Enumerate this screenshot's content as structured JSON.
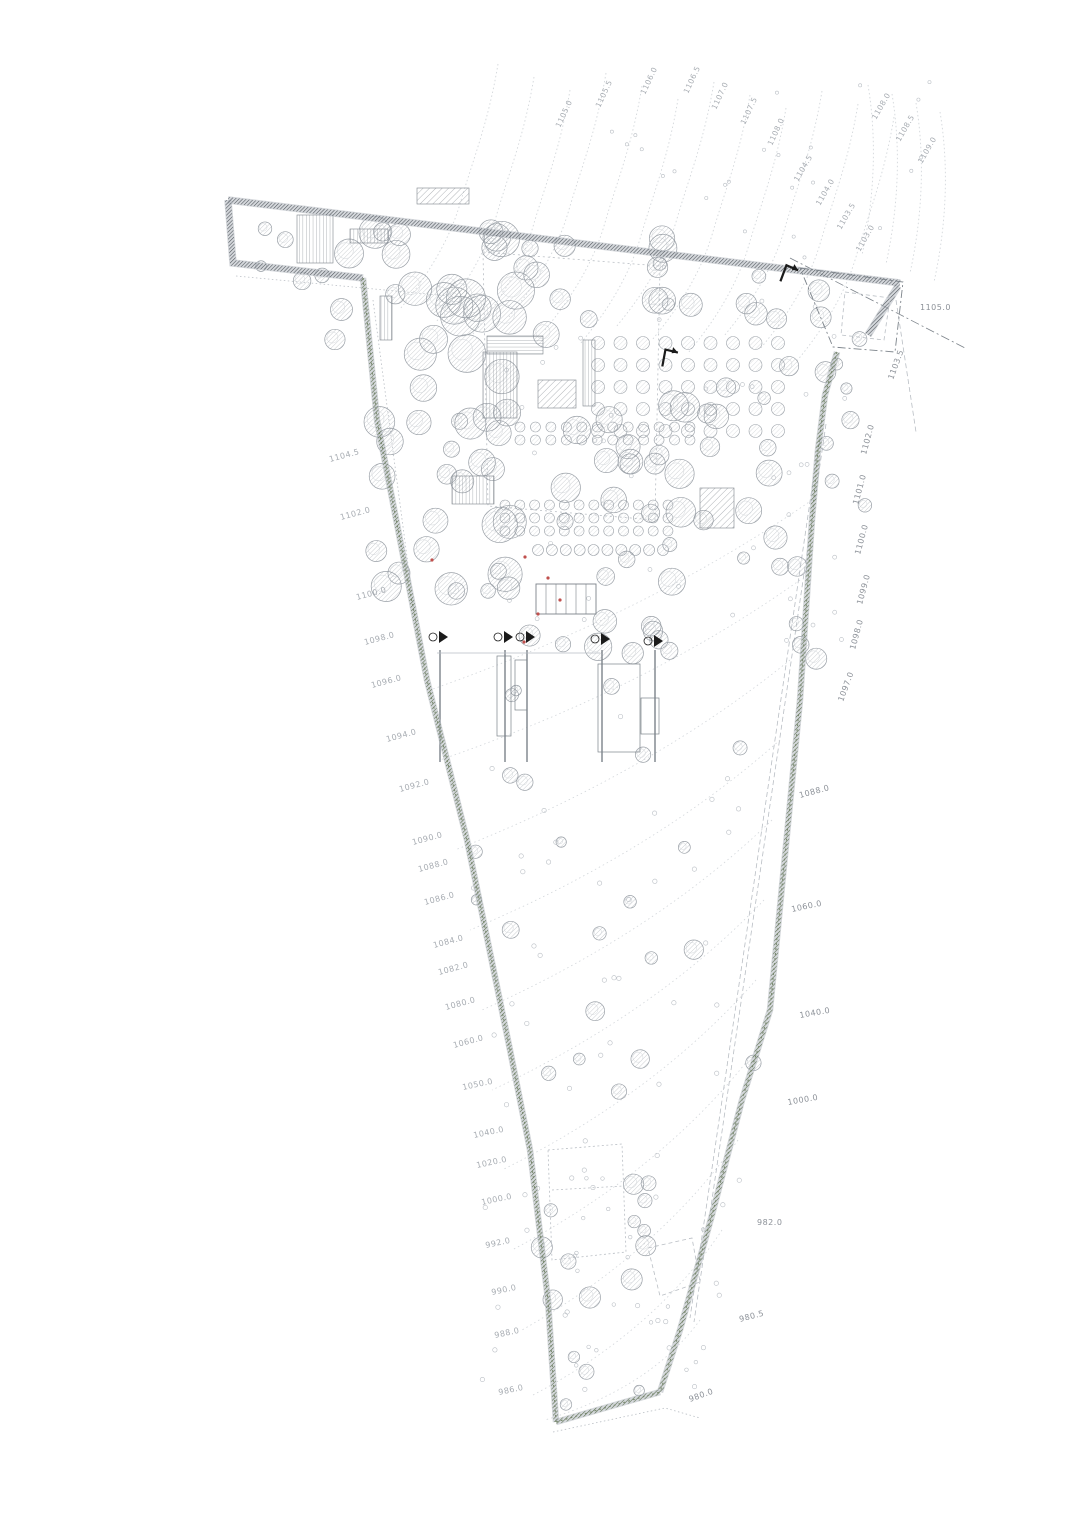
{
  "meta": {
    "drawing_type": "landscape-site-plan",
    "canvas": {
      "w": 1080,
      "h": 1526
    }
  },
  "colors": {
    "line": "#b9bec4",
    "line_faint": "#d3d7db",
    "line_dark": "#7c838a",
    "tree_stroke": "#9aa0a7",
    "tree_hatch": "#8d949b",
    "boundary_hatch": "#4b5157",
    "green_band": "#77876b",
    "green_dark": "#5c7052",
    "label": "#a7acb2",
    "label_dark": "#8c9198",
    "red": "#c0504d",
    "black": "#1b1b1b"
  },
  "boundary": {
    "top_band": [
      [
        228,
        200
      ],
      [
        900,
        283
      ]
    ],
    "west_tip_band": [
      [
        228,
        200
      ],
      [
        233,
        263
      ],
      [
        363,
        278
      ]
    ],
    "east_end_band": [
      [
        898,
        286
      ],
      [
        868,
        335
      ]
    ],
    "west_chain": [
      [
        363,
        278
      ],
      [
        377,
        420
      ],
      [
        427,
        680
      ],
      [
        467,
        840
      ],
      [
        510,
        1050
      ],
      [
        530,
        1150
      ],
      [
        548,
        1300
      ],
      [
        556,
        1422
      ]
    ],
    "east_chain": [
      [
        837,
        352
      ],
      [
        825,
        395
      ],
      [
        818,
        450
      ],
      [
        812,
        520
      ],
      [
        800,
        700
      ],
      [
        786,
        845
      ],
      [
        770,
        1010
      ],
      [
        742,
        1100
      ],
      [
        712,
        1215
      ],
      [
        680,
        1330
      ],
      [
        660,
        1392
      ]
    ],
    "bottom_band": [
      [
        556,
        1422
      ],
      [
        660,
        1392
      ]
    ],
    "protrusion_outer": [
      [
        800,
        268
      ],
      [
        903,
        282
      ],
      [
        895,
        352
      ],
      [
        833,
        347
      ]
    ],
    "protrusion_inner": [
      [
        845,
        292
      ],
      [
        890,
        298
      ],
      [
        884,
        340
      ],
      [
        841,
        335
      ]
    ]
  },
  "aux_lines": {
    "dashdot": [
      [
        [
          790,
          258
        ],
        [
          965,
          348
        ]
      ]
    ],
    "dashed": [
      [
        [
          896,
          300
        ],
        [
          916,
          432
        ]
      ],
      [
        [
          822,
          420
        ],
        [
          690,
          1318
        ]
      ],
      [
        [
          826,
          424
        ],
        [
          694,
          1322
        ]
      ]
    ],
    "dotted": [
      [
        [
          553,
          1432
        ],
        [
          665,
          1408
        ],
        [
          700,
          1418
        ]
      ],
      [
        [
          236,
          276
        ],
        [
          470,
          298
        ]
      ],
      [
        [
          373,
          300
        ],
        [
          420,
          655
        ]
      ]
    ],
    "dotted_poly": [
      [
        [
          483,
          252
        ],
        [
          660,
          266
        ],
        [
          655,
          520
        ],
        [
          488,
          506
        ],
        [
          483,
          252
        ]
      ]
    ]
  },
  "body_contours": [
    [
      [
        812,
        500
      ],
      [
        430,
        690
      ]
    ],
    [
      [
        800,
        580
      ],
      [
        440,
        760
      ]
    ],
    [
      [
        790,
        660
      ],
      [
        455,
        850
      ]
    ],
    [
      [
        780,
        740
      ],
      [
        470,
        930
      ]
    ],
    [
      [
        772,
        820
      ],
      [
        482,
        1010
      ]
    ],
    [
      [
        764,
        900
      ],
      [
        492,
        1090
      ]
    ],
    [
      [
        756,
        980
      ],
      [
        502,
        1170
      ]
    ],
    [
      [
        748,
        1060
      ],
      [
        512,
        1250
      ]
    ],
    [
      [
        738,
        1140
      ],
      [
        522,
        1330
      ]
    ],
    [
      [
        722,
        1230
      ],
      [
        533,
        1395
      ]
    ],
    [
      [
        700,
        1320
      ],
      [
        545,
        1420
      ]
    ]
  ],
  "top_contours": {
    "count": 12,
    "x0": 498,
    "y0": 64,
    "dx": 36
  },
  "corner_contours": {
    "count": 4,
    "x0": 868,
    "y0": 85,
    "dx": 24
  },
  "trees": {
    "clusters": [
      [
        330,
        225,
        200,
        130,
        26,
        8,
        20,
        1
      ],
      [
        520,
        235,
        180,
        100,
        14,
        6,
        14,
        2
      ],
      [
        700,
        275,
        160,
        240,
        18,
        6,
        13,
        3
      ],
      [
        372,
        360,
        150,
        260,
        26,
        8,
        18,
        4
      ],
      [
        520,
        400,
        180,
        130,
        16,
        8,
        16,
        5
      ],
      [
        480,
        540,
        220,
        125,
        16,
        7,
        14,
        6
      ],
      [
        700,
        520,
        120,
        140,
        8,
        6,
        12,
        7
      ],
      [
        460,
        680,
        300,
        440,
        22,
        5,
        10,
        8
      ],
      [
        540,
        1180,
        110,
        160,
        12,
        6,
        12,
        9
      ],
      [
        560,
        1350,
        80,
        55,
        4,
        5,
        8,
        10
      ],
      [
        240,
        228,
        90,
        62,
        5,
        5,
        9,
        11
      ],
      [
        826,
        360,
        48,
        160,
        5,
        5,
        8,
        12
      ]
    ],
    "small_dots": [
      [
        470,
        700,
        270,
        700,
        60,
        2.2,
        21
      ],
      [
        500,
        300,
        350,
        350,
        40,
        2.0,
        22
      ],
      [
        600,
        80,
        330,
        200,
        25,
        1.6,
        23
      ],
      [
        560,
        1160,
        150,
        240,
        18,
        1.8,
        24
      ]
    ],
    "orchard_rows": [
      [
        598,
        343,
        778,
        343,
        9,
        6.5
      ],
      [
        598,
        365,
        778,
        365,
        9,
        6.5
      ],
      [
        598,
        387,
        778,
        387,
        9,
        6.5
      ],
      [
        598,
        409,
        778,
        409,
        9,
        6.5
      ],
      [
        598,
        431,
        778,
        431,
        9,
        6.5
      ],
      [
        520,
        427,
        690,
        427,
        12,
        5
      ],
      [
        520,
        440,
        690,
        440,
        12,
        5
      ],
      [
        505,
        505,
        668,
        505,
        12,
        5
      ],
      [
        505,
        518,
        668,
        518,
        12,
        5
      ],
      [
        505,
        531,
        668,
        531,
        12,
        5
      ],
      [
        538,
        550,
        663,
        550,
        10,
        5.5
      ]
    ]
  },
  "structures": {
    "stripe_v": [
      [
        297,
        215,
        36,
        48
      ],
      [
        350,
        229,
        38,
        14
      ],
      [
        380,
        296,
        12,
        44
      ],
      [
        483,
        352,
        34,
        66
      ],
      [
        583,
        340,
        12,
        66
      ],
      [
        452,
        476,
        42,
        28
      ]
    ],
    "stripe_h": [
      [
        487,
        336,
        56,
        18
      ]
    ],
    "diag": [
      [
        538,
        380,
        38,
        28
      ],
      [
        417,
        188,
        52,
        16
      ],
      [
        700,
        488,
        34,
        40
      ]
    ],
    "room_block": {
      "x": 536,
      "y": 584,
      "w": 60,
      "h": 30,
      "dividers": 5
    },
    "rects": [
      [
        497,
        656,
        14,
        80
      ],
      [
        515,
        660,
        12,
        50
      ],
      [
        598,
        664,
        42,
        88
      ],
      [
        641,
        698,
        18,
        36
      ]
    ],
    "dotted_building": [
      [
        548,
        1150
      ],
      [
        622,
        1144
      ],
      [
        626,
        1252
      ],
      [
        552,
        1260
      ],
      [
        548,
        1150
      ]
    ],
    "dotted_building_inner": [
      [
        552,
        1190
      ],
      [
        624,
        1186
      ]
    ],
    "dashed_poly": [
      [
        648,
        1248
      ],
      [
        692,
        1238
      ],
      [
        700,
        1282
      ],
      [
        660,
        1296
      ],
      [
        648,
        1248
      ]
    ],
    "service_verticals": {
      "xs": [
        440,
        505,
        527,
        602,
        655
      ],
      "y0": 650,
      "y1": 762
    },
    "service_horizontal": [
      [
        437,
        653
      ],
      [
        600,
        653
      ]
    ]
  },
  "markers": {
    "sections": [
      [
        440,
        637
      ],
      [
        505,
        637
      ],
      [
        527,
        637
      ],
      [
        602,
        639
      ],
      [
        655,
        641
      ]
    ],
    "bent_arrows": [
      [
        668,
        355,
        -25
      ],
      [
        788,
        271,
        -15
      ]
    ],
    "red_dots": [
      [
        548,
        578
      ],
      [
        538,
        614
      ],
      [
        524,
        642
      ],
      [
        560,
        600
      ],
      [
        525,
        557
      ],
      [
        432,
        560
      ]
    ]
  },
  "labels": {
    "left": [
      [
        330,
        462,
        -15,
        "1104.5"
      ],
      [
        341,
        520,
        -15,
        "1102.0"
      ],
      [
        357,
        600,
        -15,
        "1100.0"
      ],
      [
        365,
        645,
        -15,
        "1098.0"
      ],
      [
        372,
        688,
        -15,
        "1096.0"
      ],
      [
        387,
        742,
        -15,
        "1094.0"
      ],
      [
        400,
        792,
        -15,
        "1092.0"
      ],
      [
        413,
        845,
        -15,
        "1090.0"
      ],
      [
        419,
        872,
        -15,
        "1088.0"
      ],
      [
        425,
        905,
        -15,
        "1086.0"
      ],
      [
        434,
        948,
        -15,
        "1084.0"
      ],
      [
        439,
        975,
        -15,
        "1082.0"
      ],
      [
        446,
        1010,
        -15,
        "1080.0"
      ],
      [
        454,
        1048,
        -15,
        "1060.0"
      ],
      [
        463,
        1090,
        -12,
        "1050.0"
      ],
      [
        474,
        1138,
        -12,
        "1040.0"
      ],
      [
        477,
        1168,
        -12,
        "1020.0"
      ],
      [
        482,
        1205,
        -12,
        "1000.0"
      ],
      [
        486,
        1248,
        -12,
        "992.0"
      ],
      [
        492,
        1295,
        -12,
        "990.0"
      ],
      [
        495,
        1338,
        -12,
        "988.0"
      ],
      [
        499,
        1395,
        -12,
        "986.0"
      ]
    ],
    "right": [
      [
        920,
        310,
        0,
        "1105.0"
      ],
      [
        893,
        380,
        -70,
        "1103.5"
      ],
      [
        866,
        455,
        -75,
        "1102.0"
      ],
      [
        858,
        505,
        -75,
        "1101.0"
      ],
      [
        860,
        555,
        -75,
        "1100.0"
      ],
      [
        862,
        605,
        -75,
        "1099.0"
      ],
      [
        855,
        650,
        -75,
        "1098.0"
      ],
      [
        843,
        702,
        -70,
        "1097.0"
      ],
      [
        800,
        798,
        -15,
        "1088.0"
      ],
      [
        792,
        912,
        -12,
        "1060.0"
      ],
      [
        800,
        1018,
        -10,
        "1040.0"
      ],
      [
        788,
        1105,
        -10,
        "1000.0"
      ],
      [
        757,
        1225,
        0,
        "982.0"
      ],
      [
        740,
        1322,
        -15,
        "980.5"
      ],
      [
        690,
        1402,
        -20,
        "980.0"
      ]
    ],
    "top": [
      [
        560,
        128,
        -65,
        "1105.0"
      ],
      [
        600,
        108,
        -65,
        "1105.5"
      ],
      [
        645,
        95,
        -65,
        "1106.0"
      ],
      [
        688,
        94,
        -65,
        "1106.5"
      ],
      [
        716,
        110,
        -65,
        "1107.0"
      ],
      [
        745,
        125,
        -65,
        "1107.5"
      ],
      [
        772,
        146,
        -65,
        "1108.0"
      ],
      [
        798,
        182,
        -60,
        "1104.5"
      ],
      [
        820,
        206,
        -60,
        "1104.0"
      ],
      [
        841,
        230,
        -60,
        "1103.5"
      ],
      [
        860,
        252,
        -60,
        "1103.0"
      ],
      [
        876,
        120,
        -60,
        "1108.0"
      ],
      [
        900,
        142,
        -60,
        "1108.5"
      ],
      [
        922,
        164,
        -60,
        "1109.0"
      ]
    ]
  }
}
